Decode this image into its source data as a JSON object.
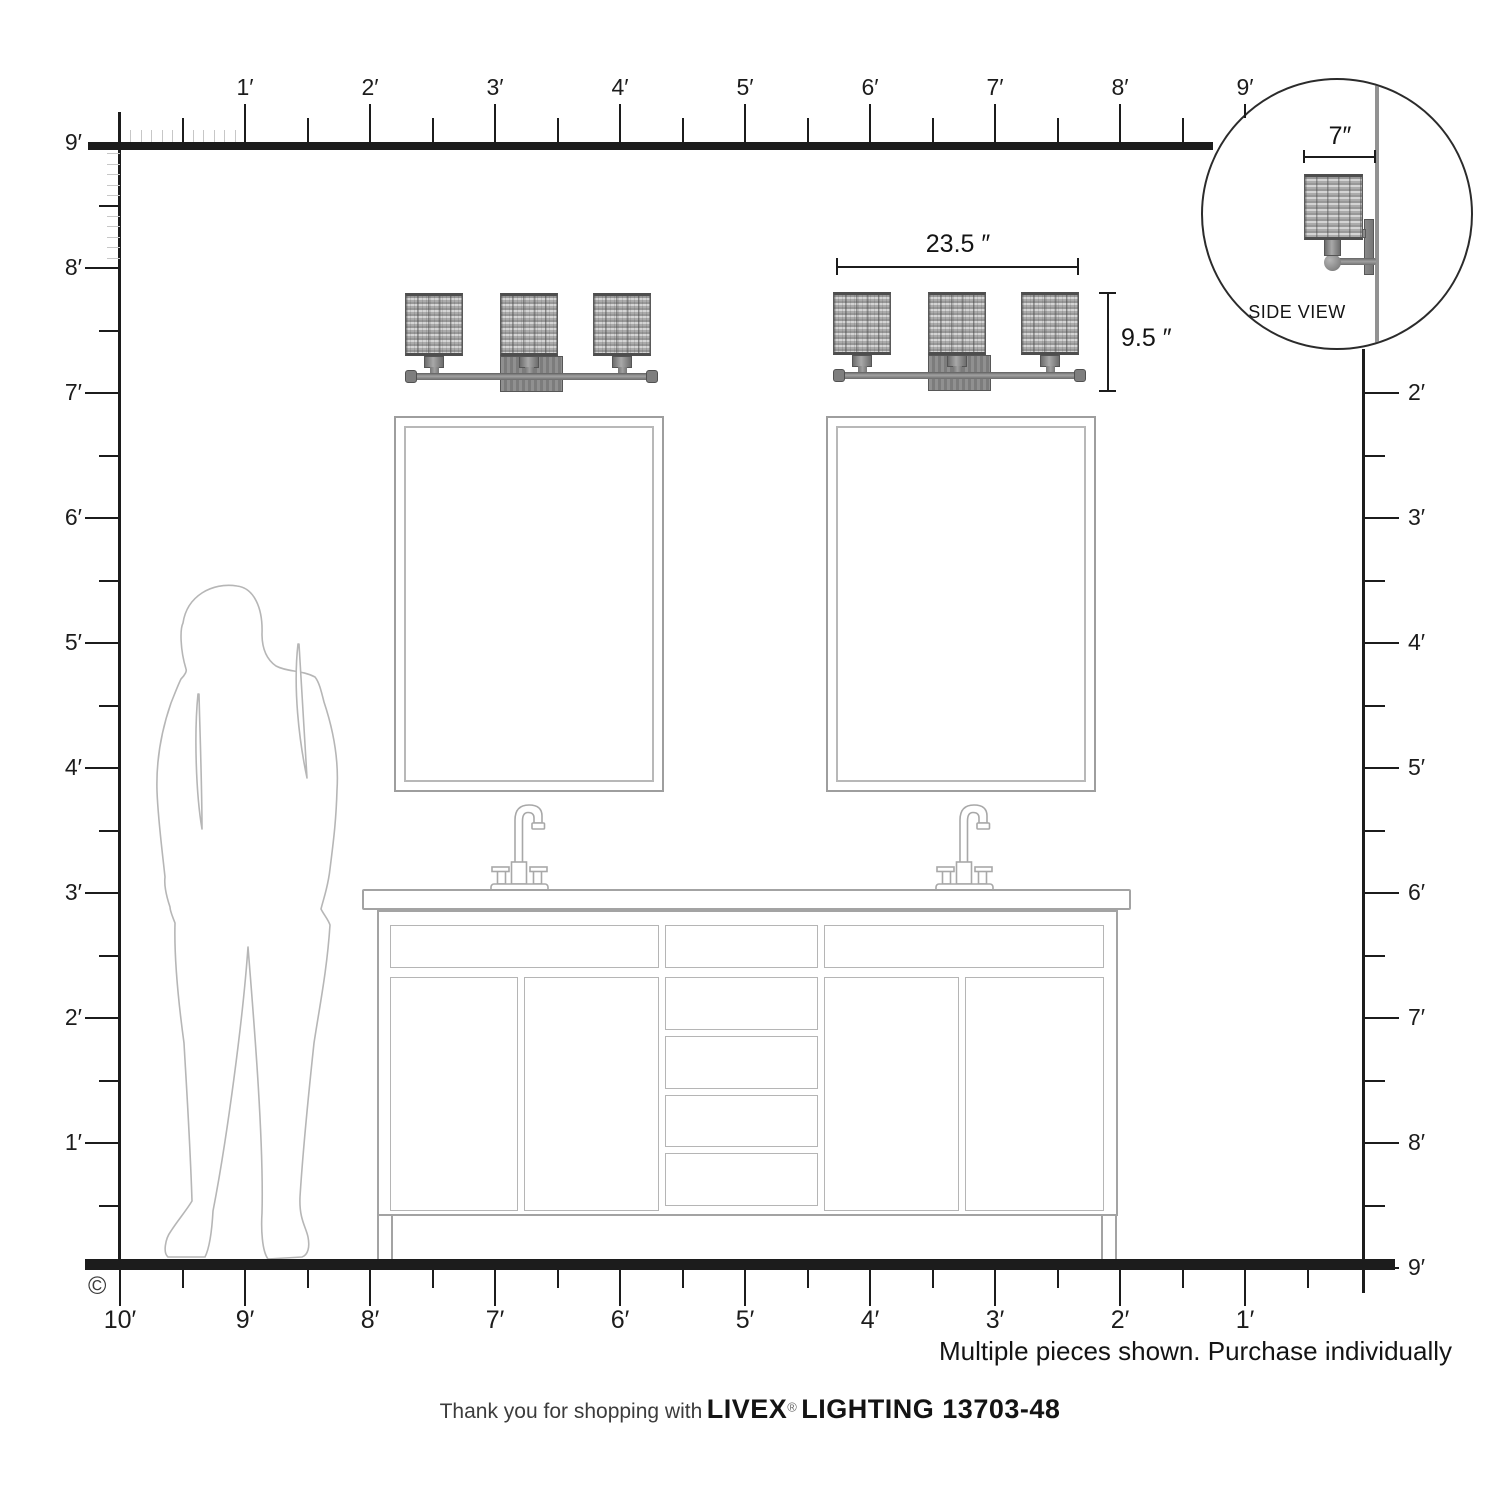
{
  "page": {
    "copyright": "©"
  },
  "rulers": {
    "top_labels": [
      "1′",
      "2′",
      "3′",
      "4′",
      "5′",
      "6′",
      "7′",
      "8′",
      "9′"
    ],
    "left_labels": [
      "9′",
      "8′",
      "7′",
      "6′",
      "5′",
      "4′",
      "3′",
      "2′",
      "1′"
    ],
    "right_labels": [
      "2′",
      "3′",
      "4′",
      "5′",
      "6′",
      "7′",
      "8′",
      "9′"
    ],
    "bottom_labels": [
      "10′",
      "9′",
      "8′",
      "7′",
      "6′",
      "5′",
      "4′",
      "3′",
      "2′",
      "1′"
    ]
  },
  "annotations": {
    "fixture_width": "23.5 ″",
    "fixture_height": "9.5 ″",
    "fixture_depth": "7″",
    "side_view": "SIDE VIEW",
    "note": "Multiple pieces shown. Purchase individually"
  },
  "footer": {
    "thanks": "Thank you for shopping with",
    "brand": "LIVEX",
    "registered": "®",
    "product": "LIGHTING 13703-48"
  }
}
